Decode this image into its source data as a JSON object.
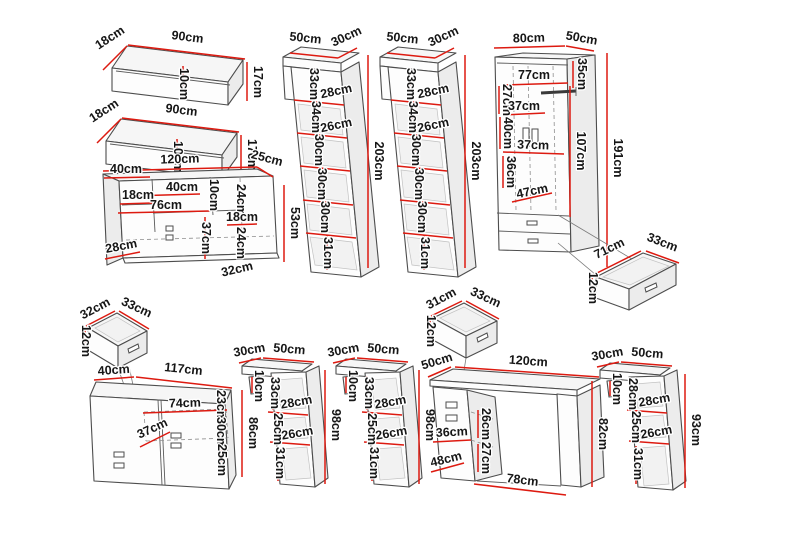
{
  "diagram_title": "furniture-set-dimension-diagram",
  "unit": "cm",
  "colors": {
    "dimension_line": "#dd1a10",
    "outline": "#4d4d4d",
    "label_text": "#161616",
    "background": "#ffffff"
  },
  "pieces": [
    {
      "name": "wall-shelf-upper",
      "labels": {
        "depth": "18cm",
        "width": "90cm",
        "inner_height": "10cm",
        "height": "17cm"
      }
    },
    {
      "name": "wall-shelf-lower",
      "labels": {
        "depth": "18cm",
        "width": "90cm",
        "inner_height": "10cm",
        "height": "17cm"
      }
    },
    {
      "name": "tall-cabinet-left",
      "labels": {
        "width": "50cm",
        "depth": "30cm",
        "s1": "33cm",
        "o1": "28cm",
        "s2": "34cm",
        "o2": "26cm",
        "s3": "30cm",
        "s4": "30cm",
        "s5": "30cm",
        "s6": "31cm",
        "height": "203cm"
      }
    },
    {
      "name": "tall-cabinet-right",
      "labels": {
        "width": "50cm",
        "depth": "30cm",
        "s1": "33cm",
        "o1": "28cm",
        "s2": "34cm",
        "o2": "26cm",
        "s3": "30cm",
        "s4": "30cm",
        "s5": "30cm",
        "s6": "31cm",
        "height": "203cm"
      }
    },
    {
      "name": "wardrobe",
      "labels": {
        "width": "80cm",
        "depth": "50cm",
        "top_section": "35cm",
        "inner_width": "77cm",
        "h27": "27cm",
        "shelf37a": "37cm",
        "h40": "40cm",
        "shelf37b": "37cm",
        "h36": "36cm",
        "drawer_zone": "47cm",
        "inner_height": "107cm",
        "height": "191cm"
      }
    },
    {
      "name": "wardrobe-drawer",
      "labels": {
        "width": "71cm",
        "depth": "33cm",
        "height": "12cm"
      }
    },
    {
      "name": "wall-cabinet",
      "labels": {
        "width": "120cm",
        "depth": "25cm",
        "w40_left": "40cm",
        "h18_left": "18cm",
        "w40_mid": "40cm",
        "h10": "10cm",
        "h24_upper": "24cm",
        "w76": "76cm",
        "h18_right": "18cm",
        "h37": "37cm",
        "h24_lower": "24cm",
        "d28": "28cm",
        "d32": "32cm",
        "height": "53cm"
      }
    },
    {
      "name": "drawer-left",
      "labels": {
        "width": "32cm",
        "depth": "33cm",
        "height": "12cm"
      }
    },
    {
      "name": "sideboard",
      "labels": {
        "depth": "40cm",
        "width": "117cm",
        "h23": "23cm",
        "w74": "74cm",
        "h30": "30cm",
        "d37": "37cm",
        "h25": "25cm",
        "height": "86cm"
      }
    },
    {
      "name": "bookcase-left",
      "labels": {
        "depth": "30cm",
        "width": "50cm",
        "h10": "10cm",
        "s1": "33cm",
        "o1": "28cm",
        "s2": "25cm",
        "o2": "26cm",
        "s3": "31cm",
        "height": "98cm"
      }
    },
    {
      "name": "bookcase-middle",
      "labels": {
        "depth": "30cm",
        "width": "50cm",
        "h10": "10cm",
        "s1": "33cm",
        "o1": "28cm",
        "s2": "25cm",
        "o2": "26cm",
        "s3": "31cm",
        "height": "98cm"
      }
    },
    {
      "name": "desk-drawer",
      "labels": {
        "width": "31cm",
        "depth": "33cm",
        "height": "12cm"
      }
    },
    {
      "name": "desk",
      "labels": {
        "depth": "50cm",
        "width": "120cm",
        "h26": "26cm",
        "w36": "36cm",
        "h27": "27cm",
        "d48": "48cm",
        "w78": "78cm",
        "height": "82cm"
      }
    },
    {
      "name": "bookcase-right",
      "labels": {
        "depth": "30cm",
        "width": "50cm",
        "h10": "10cm",
        "s1": "28cm",
        "o1": "28cm",
        "s2": "25cm",
        "o2": "26cm",
        "s3": "31cm",
        "height": "93cm"
      }
    }
  ]
}
